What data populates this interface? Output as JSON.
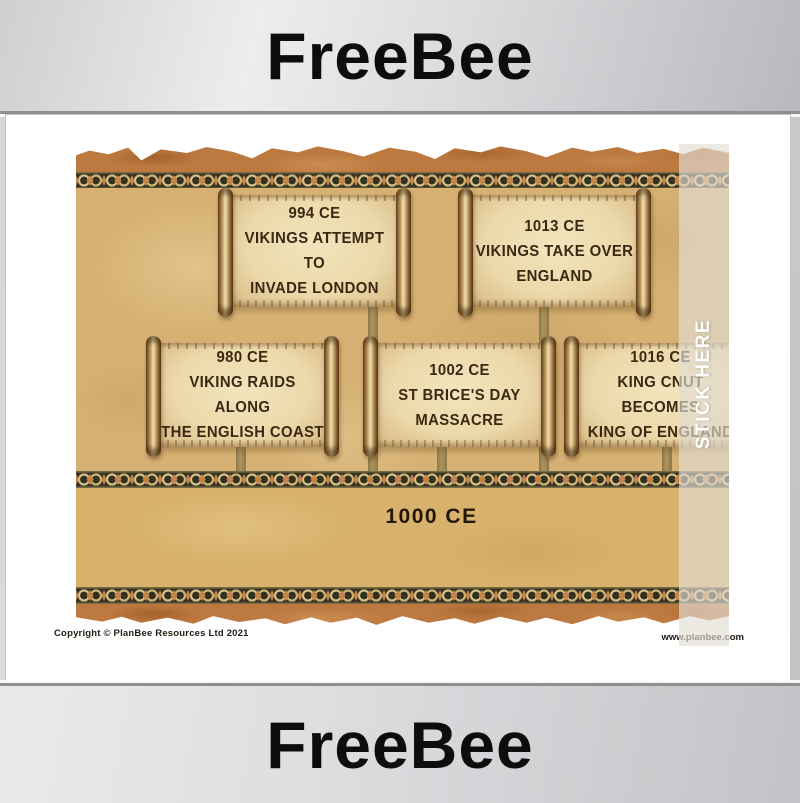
{
  "banners": {
    "top": "FreeBee",
    "bottom": "FreeBee"
  },
  "poster": {
    "events": [
      {
        "date": "994 CE",
        "line1": "VIKINGS ATTEMPT TO",
        "line2": "INVADE LONDON"
      },
      {
        "date": "1013 CE",
        "line1": "VIKINGS TAKE OVER",
        "line2": "ENGLAND"
      },
      {
        "date": "980 CE",
        "line1": "VIKING RAIDS ALONG",
        "line2": "THE ENGLISH COAST"
      },
      {
        "date": "1002 CE",
        "line1": "ST BRICE'S DAY",
        "line2": "MASSACRE"
      },
      {
        "date": "1016 CE",
        "line1": "KING CNUT BECOMES",
        "line2": "KING OF ENGLAND"
      }
    ],
    "timeline_label": "1000 CE",
    "overlay_label": "STICK HERE",
    "colors": {
      "parchment_background": "#d6b173",
      "torn_edge_rust": "#bd7a40",
      "border_band_dark": "#353220",
      "border_knot_tan": "#d6c08a",
      "border_accent_orange": "#c8854a",
      "scroll_text_brown": "#3a2812",
      "banner_gray": "#d3d5d7"
    }
  },
  "footer": {
    "copyright": "Copyright © PlanBee Resources Ltd 2021",
    "website": "www.planbee.com"
  }
}
